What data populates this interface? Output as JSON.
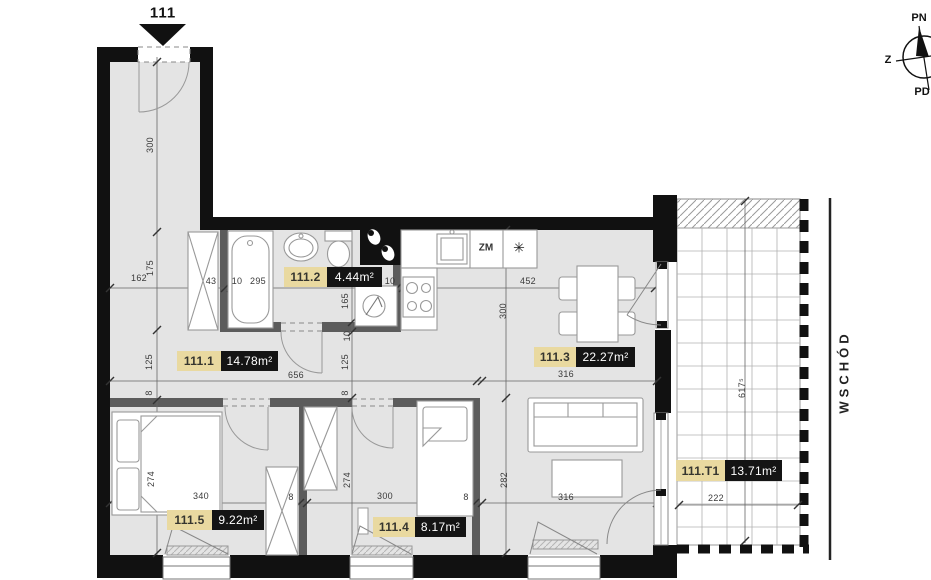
{
  "unit": {
    "number": "111"
  },
  "rooms": {
    "r1": {
      "id": "111.1",
      "area": "14.78m²"
    },
    "r2": {
      "id": "111.2",
      "area": "4.44m²"
    },
    "r3": {
      "id": "111.3",
      "area": "22.27m²"
    },
    "r4": {
      "id": "111.4",
      "area": "8.17m²"
    },
    "r5": {
      "id": "111.5",
      "area": "9.22m²"
    },
    "t1": {
      "id": "111.T1",
      "area": "13.71m²"
    }
  },
  "kitchen": {
    "dishwasher_label": "ZM",
    "fridge_symbol": "✳"
  },
  "compass": {
    "north": "PN",
    "west": "Z",
    "south": "PD"
  },
  "east_label": "WSCHÓD",
  "colors": {
    "floor": "#e4e4e4",
    "wall": "#111111",
    "room_tag_bg": "#e9d9a0",
    "area_tag_bg": "#141414"
  },
  "dims": {
    "d0": "300",
    "d1": "175",
    "d2": "162",
    "d3": "43",
    "d4": "10",
    "d5": "295",
    "d6": "10",
    "d7": "452",
    "d8": "165",
    "d9": "10",
    "d10": "125",
    "d11": "125",
    "d12": "656",
    "d13": "316",
    "d14": "8",
    "d15": "8",
    "d16": "300",
    "d17": "274",
    "d18": "274",
    "d19": "282",
    "d20": "340",
    "d21": "8",
    "d22": "300",
    "d23": "8",
    "d24": "316",
    "d25": "222",
    "d26": "617⁵"
  }
}
